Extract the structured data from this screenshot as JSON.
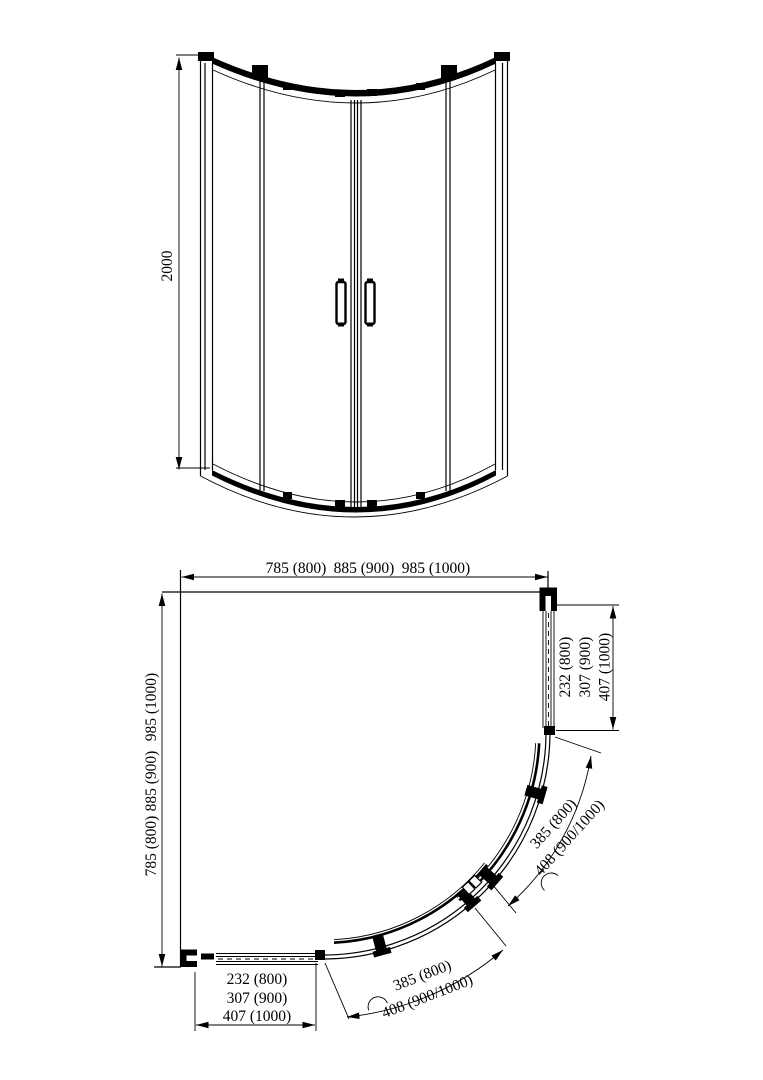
{
  "front_view": {
    "height": "2000"
  },
  "plan_view": {
    "top_widths": [
      "785 (800)",
      "885 (900)",
      "985 (1000)"
    ],
    "left_depths": [
      "785 (800)",
      "885 (900)",
      "985 (1000)"
    ],
    "right_side": [
      "232 (800)",
      "307 (900)",
      "407 (1000)"
    ],
    "bottom_side": [
      "232 (800)",
      "307 (900)",
      "407 (1000)"
    ],
    "right_door_arc": [
      "385 (800)",
      "408 (900/1000)"
    ],
    "bottom_door_arc": [
      "385 (800)",
      "408 (900/1000)"
    ]
  },
  "colors": {
    "line": "#000000",
    "background": "#ffffff"
  }
}
